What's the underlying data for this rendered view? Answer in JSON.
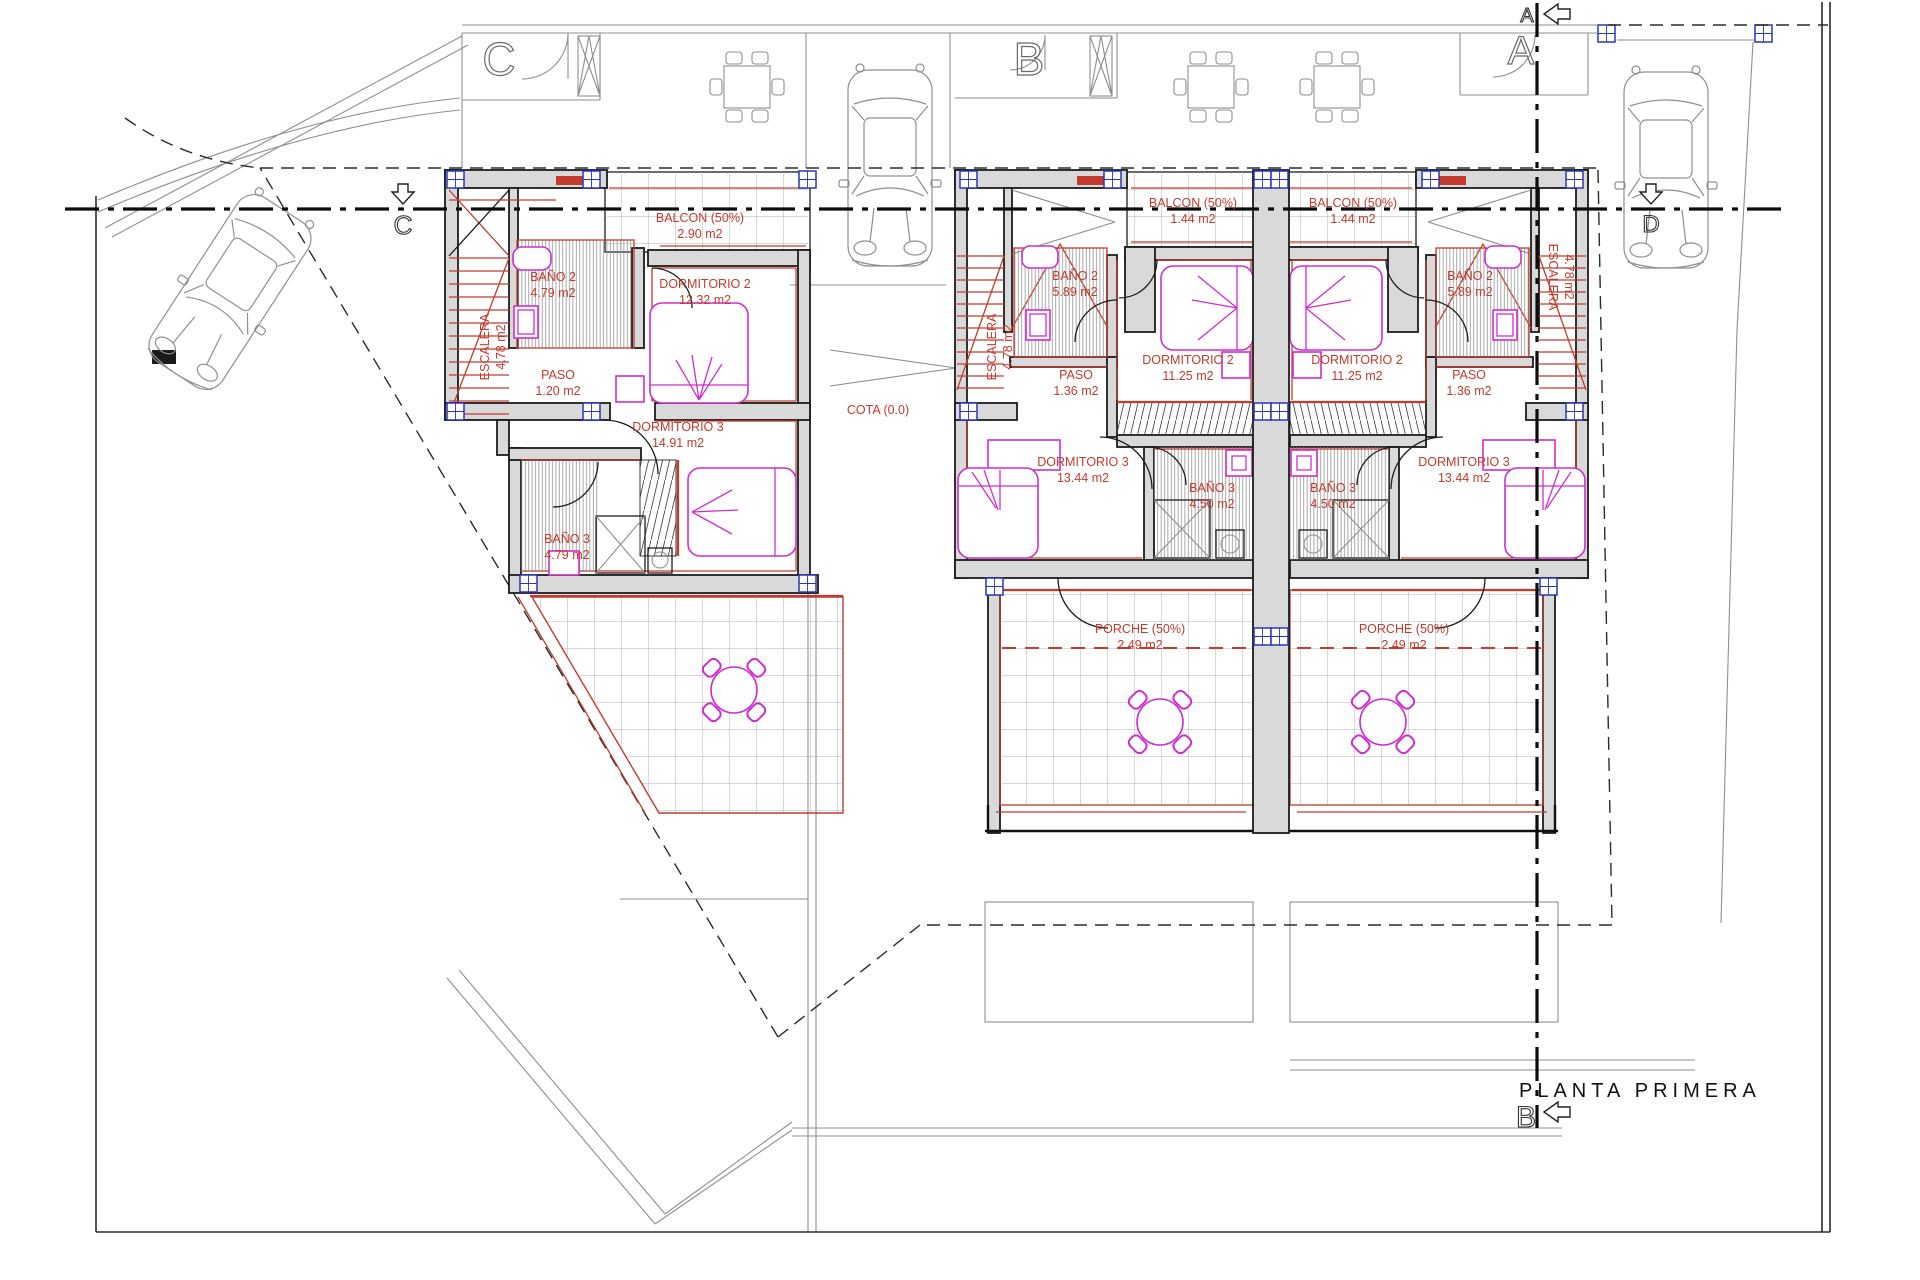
{
  "drawing": {
    "title": "PLANTA PRIMERA",
    "cota": "COTA (0.0)"
  },
  "markers": {
    "section_a_top": "A",
    "door_a_top_right": "A",
    "door_b_top": "B",
    "door_c_top_left": "C",
    "section_c_left": "C",
    "section_d_right": "D",
    "section_b_bottom": "B"
  },
  "palette": {
    "wall_fill": "#d9d9d9",
    "line_red": "#c23b2e",
    "furniture_magenta": "#cd2fcd",
    "pillar_blue": "#2c35b5"
  },
  "units": [
    {
      "id": "unit-left",
      "rooms": {
        "escalera": {
          "name": "ESCALERA",
          "area": "4.78 m2"
        },
        "balcon": {
          "name": "BALCON (50%)",
          "area": "2.90 m2"
        },
        "bano2": {
          "name": "BAÑO 2",
          "area": "4.79 m2"
        },
        "dormitorio2": {
          "name": "DORMITORIO 2",
          "area": "12.32 m2"
        },
        "paso": {
          "name": "PASO",
          "area": "1.20 m2"
        },
        "dormitorio3": {
          "name": "DORMITORIO 3",
          "area": "14.91 m2"
        },
        "bano3": {
          "name": "BAÑO 3",
          "area": "4.79 m2"
        }
      }
    },
    {
      "id": "unit-middle",
      "rooms": {
        "escalera": {
          "name": "ESCALERA",
          "area": "4.78 m2"
        },
        "balcon": {
          "name": "BALCON (50%)",
          "area": "1.44 m2"
        },
        "bano2": {
          "name": "BAÑO 2",
          "area": "5.89 m2"
        },
        "dormitorio2": {
          "name": "DORMITORIO 2",
          "area": "11.25 m2"
        },
        "paso": {
          "name": "PASO",
          "area": "1.36 m2"
        },
        "dormitorio3": {
          "name": "DORMITORIO 3",
          "area": "13.44 m2"
        },
        "bano3": {
          "name": "BAÑO 3",
          "area": "4.50 m2"
        },
        "porche": {
          "name": "PORCHE (50%)",
          "area": "2.49 m2"
        }
      }
    },
    {
      "id": "unit-right",
      "rooms": {
        "escalera": {
          "name": "ESCALERA",
          "area": "4.78 m2"
        },
        "balcon": {
          "name": "BALCON (50%)",
          "area": "1.44 m2"
        },
        "bano2": {
          "name": "BAÑO 2",
          "area": "5.89 m2"
        },
        "dormitorio2": {
          "name": "DORMITORIO 2",
          "area": "11.25 m2"
        },
        "paso": {
          "name": "PASO",
          "area": "1.36 m2"
        },
        "dormitorio3": {
          "name": "DORMITORIO 3",
          "area": "13.44 m2"
        },
        "bano3": {
          "name": "BAÑO 3",
          "area": "4.50 m2"
        },
        "porche": {
          "name": "PORCHE (50%)",
          "area": "2.49 m2"
        }
      }
    }
  ]
}
